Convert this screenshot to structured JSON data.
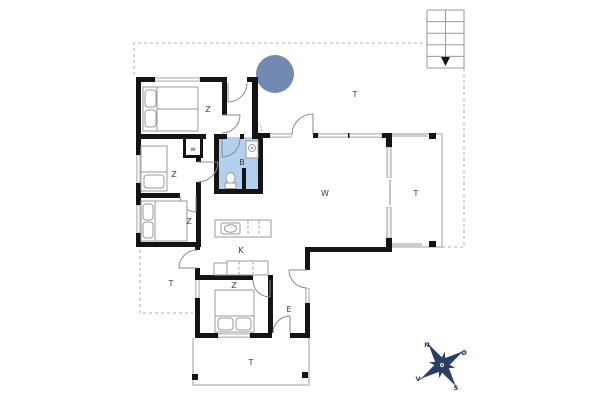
{
  "floorplan": {
    "room_labels": {
      "bedroom_top": "Z",
      "bedroom_middle": "Z",
      "bedroom_lower": "Z",
      "bedroom_bottom": "Z",
      "wardrobe": "w",
      "bathroom": "B",
      "kitchen": "K",
      "living_room": "W",
      "entry": "E",
      "terrace_north": "T",
      "terrace_east": "T",
      "terrace_west": "T",
      "terrace_south": "T"
    },
    "compass": {
      "north": "N",
      "east": "Ø",
      "south": "S",
      "west": "V"
    },
    "colors": {
      "wall": "#141414",
      "window": "#cccccc",
      "fixture": "#9a9a9a",
      "door_arc": "#8a8a8a",
      "boundary": "#b0b0b0",
      "bathroom_fill": "#b3d0ee",
      "hot_tub_fill": "#7289b2",
      "compass_navy": "#2b3f66",
      "label_text": "#3a3a3a",
      "background": "#ffffff"
    }
  }
}
